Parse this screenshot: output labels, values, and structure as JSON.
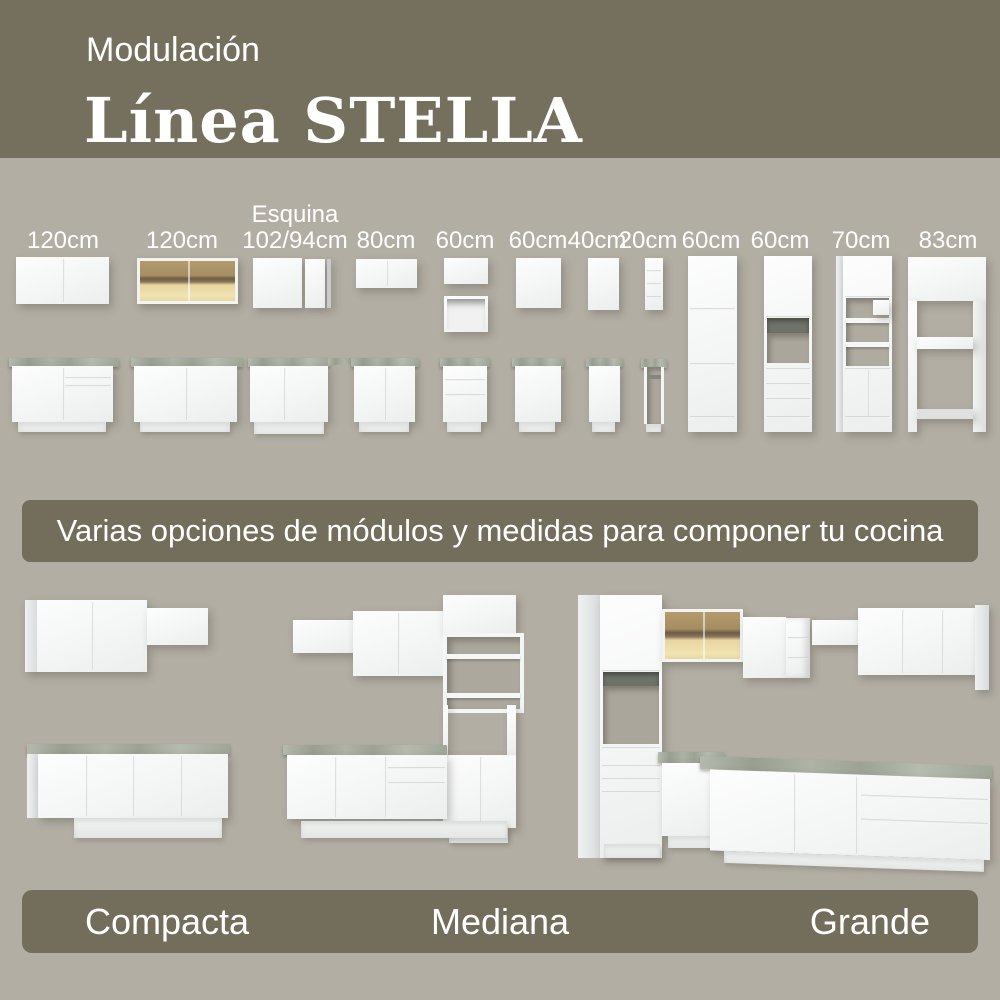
{
  "header": {
    "kicker": "Modulación",
    "title": "Línea STELLA"
  },
  "module_sizes": [
    {
      "label": "120cm"
    },
    {
      "label": "120cm"
    },
    {
      "label_line1": "Esquina",
      "label": "102/94cm"
    },
    {
      "label": "80cm"
    },
    {
      "label": "60cm"
    },
    {
      "label": "60cm"
    },
    {
      "label": "40cm"
    },
    {
      "label": "20cm"
    },
    {
      "label": "60cm"
    },
    {
      "label": "60cm"
    },
    {
      "label": "70cm"
    },
    {
      "label": "83cm"
    }
  ],
  "banner": {
    "text": "Varias opciones de módulos y medidas para componer tu cocina"
  },
  "kitchens": [
    {
      "name": "Compacta"
    },
    {
      "name": "Mediana"
    },
    {
      "name": "Grande"
    }
  ],
  "palette": {
    "header_bg": "#756f5e",
    "page_bg": "#b3aea4",
    "band_bg": "#736d5c",
    "text_white": "#ffffff",
    "cabinet_white": "#f4f5f5",
    "countertop_gray": "#a4aa9c",
    "glass_amber": "#c2a978",
    "glass_shelf_brown": "#6f5c46"
  }
}
